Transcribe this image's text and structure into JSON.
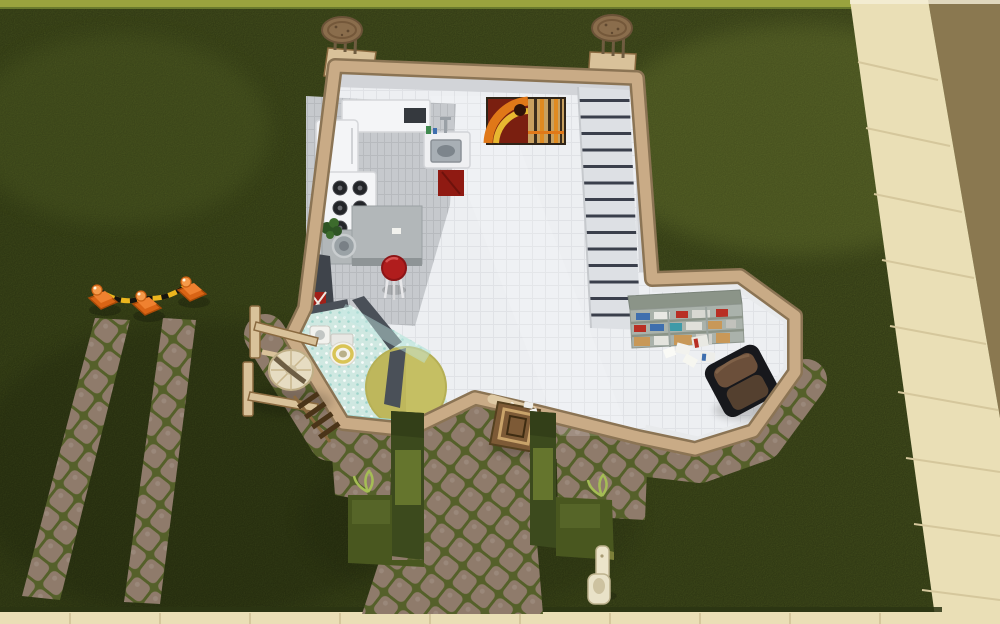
{
  "scene": {
    "domain": "game",
    "view": "top-down cutaway view of a residential lot",
    "setting": "small one-room house with kitchen, bathroom, staircase and reading nook on a grass lot, cobblestone paths, hedges, traffic cones, sidewalk and road at the edges"
  },
  "colors": {
    "grass": "#4a571f",
    "grassTop": "#9aa33e",
    "sidewalk": "#ead FB6",
    "sidewalkSeam": "#d5c79c",
    "road": "#8a7850",
    "cobble": "#8f7b6b",
    "cobbleGap": "#55602a",
    "wallTan": "#c9ab86",
    "wallEdge": "#8b7454",
    "floor": "#edeff2",
    "floorLine": "#e0e2e6",
    "kitchenFloor": "#c6c9cd",
    "stairDark": "#3a3f4b",
    "bathFloor": "#cfe8e1",
    "bathTeal": "#9ed8d1",
    "rug": "#c5bf63",
    "darkWall": "#4a5058",
    "fridge": "#f4f5f7",
    "burner": "#222428",
    "counter": "#b2b7b9",
    "stoolRed": "#b01d1d",
    "towelRed": "#8f1a12",
    "steel": "#9aa2a8",
    "shelfTop": "#8b9488",
    "bookBlue": "#3f6fae",
    "bookRed": "#b82f24",
    "boxTan": "#c89858",
    "chairShell": "#17181c",
    "chairLeather": "#6b4f3a",
    "wood": "#d9c29a",
    "woodDark": "#8a6a40",
    "crate": "#7d5a36",
    "hedge": "#3c4a1d",
    "hedgeLight": "#6c7c30",
    "sprig": "#a5bd55",
    "cone": "#e5731f",
    "tape": "#ecb61e",
    "mailbox": "#e9e2c8",
    "chimneyCap": "#8a6d4c",
    "paintRed": "#7a1f10",
    "paintOrange": "#e07818",
    "paintYellow": "#e8b830",
    "paintTan": "#c8a060"
  },
  "objects": {
    "house": "cutaway house with tan wall tops",
    "chimney_left": "round-cap chimney, north-west corner",
    "chimney_right": "round-cap chimney, north-east corner",
    "stairs": "staircase along east wall",
    "painting": "abstract orange wall painting",
    "wall_sink": "wall-mounted sink with faucet and red towel",
    "north_counter": "white counter with microwave",
    "fridge": "white refrigerator",
    "stove": "white range with six burners",
    "kitchen_counter": "gray counter with round basin and plant",
    "island": "concrete kitchen island",
    "barstool": "red-seat barstool",
    "dark_cabinet": "tall dark cabinet with patterned towel",
    "bathroom": "bathroom with mint mosaic floor",
    "toilet": "toilet with gold seat",
    "bath_sink": "small white bathroom sink",
    "shower_glass": "glass shower screen",
    "rug": "round olive-yellow rug",
    "bookshelf": "cutaway shelf unit with books and boxes",
    "armchair": "dark leather armchair",
    "papers": "scattered books and papers",
    "front_door": "front door on south wall",
    "planter_crate": "wooden planter crate by the door",
    "hedge_left": "L-shaped hedge left of path",
    "hedge_right": "L-shaped hedge right of path",
    "easel": "wooden easel with round wicker seat",
    "cones": "three traffic cones with caution tape",
    "mailbox": "curbside mailbox",
    "main_path": "cobblestone walkway to front door",
    "path_strips": "two worn cobblestone strips",
    "sidewalk_right": "sidewalk along the road",
    "sidewalk_bottom": "sidewalk at bottom edge",
    "road": "street pavement, top-right"
  }
}
